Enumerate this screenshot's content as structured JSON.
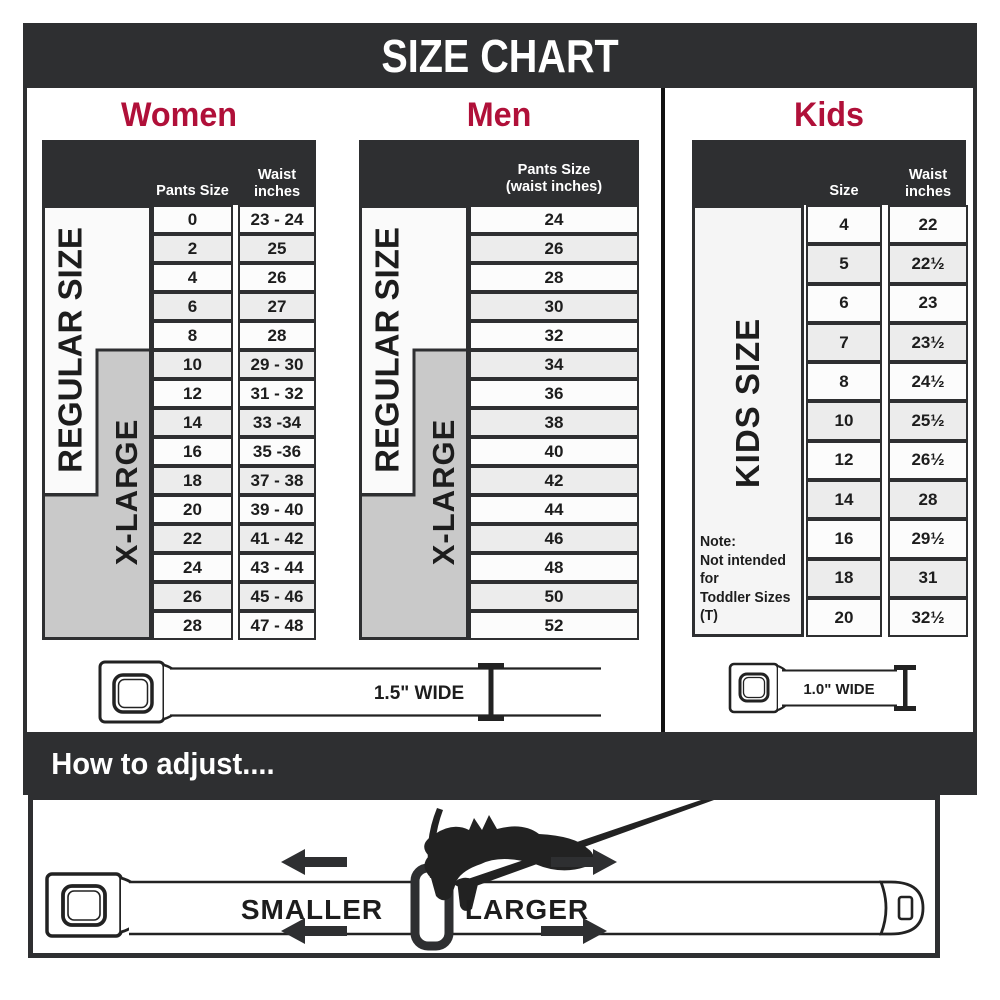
{
  "title": "SIZE CHART",
  "colors": {
    "accent": "#b01039",
    "dark": "#2e2f31"
  },
  "women": {
    "heading": "Women",
    "pants_size_header": "Pants Size",
    "waist_header_line1": "Waist",
    "waist_header_line2": "inches",
    "regular_label": "REGULAR SIZE",
    "xlarge_label": "X-LARGE",
    "rows": [
      [
        "0",
        "23 - 24"
      ],
      [
        "2",
        "25"
      ],
      [
        "4",
        "26"
      ],
      [
        "6",
        "27"
      ],
      [
        "8",
        "28"
      ],
      [
        "10",
        "29 - 30"
      ],
      [
        "12",
        "31 - 32"
      ],
      [
        "14",
        "33 -34"
      ],
      [
        "16",
        "35 -36"
      ],
      [
        "18",
        "37 - 38"
      ],
      [
        "20",
        "39 - 40"
      ],
      [
        "22",
        "41 - 42"
      ],
      [
        "24",
        "43 - 44"
      ],
      [
        "26",
        "45 - 46"
      ],
      [
        "28",
        "47 - 48"
      ]
    ]
  },
  "men": {
    "heading": "Men",
    "header_line1": "Pants Size",
    "header_line2": "(waist inches)",
    "regular_label": "REGULAR SIZE",
    "xlarge_label": "X-LARGE",
    "rows": [
      "24",
      "26",
      "28",
      "30",
      "32",
      "34",
      "36",
      "38",
      "40",
      "42",
      "44",
      "46",
      "48",
      "50",
      "52"
    ]
  },
  "kids": {
    "heading": "Kids",
    "size_header": "Size",
    "waist_header_line1": "Waist",
    "waist_header_line2": "inches",
    "kids_label": "KIDS SIZE",
    "note_line1": "Note:",
    "note_line2": "Not intended for",
    "note_line3": "Toddler Sizes (T)",
    "rows": [
      [
        "4",
        "22"
      ],
      [
        "5",
        "22½"
      ],
      [
        "6",
        "23"
      ],
      [
        "7",
        "23½"
      ],
      [
        "8",
        "24½"
      ],
      [
        "10",
        "25½"
      ],
      [
        "12",
        "26½"
      ],
      [
        "14",
        "28"
      ],
      [
        "16",
        "29½"
      ],
      [
        "18",
        "31"
      ],
      [
        "20",
        "32½"
      ]
    ]
  },
  "belts": {
    "adult_width_label": "1.5\" WIDE",
    "kids_width_label": "1.0\" WIDE"
  },
  "adjust": {
    "heading": "How to adjust....",
    "smaller_label": "SMALLER",
    "larger_label": "LARGER"
  }
}
